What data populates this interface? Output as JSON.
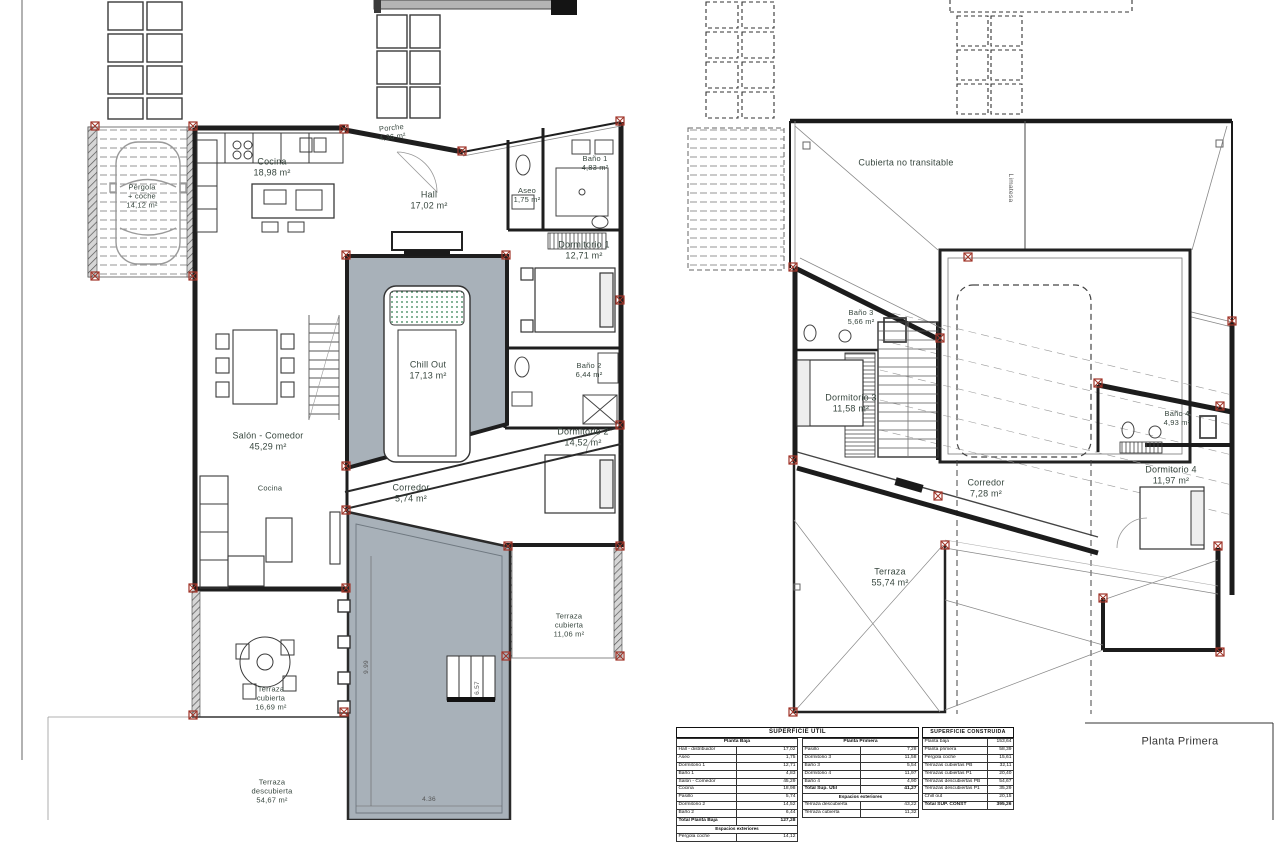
{
  "colors": {
    "label_text": "#37463e",
    "wall": "#1e1e1e",
    "pool_gray": "#a8b1b9",
    "marker_red": "#a03428"
  },
  "plan_left": {
    "labels": {
      "pergola": "Pérgola\n+ coche\n14,12 m²",
      "porche": "Porche\n4,36 m²",
      "cocina": "Cocina\n18,98 m²",
      "hall": "Hall\n17,02 m²",
      "aseo": "Aseo\n1,75 m²",
      "bano1": "Baño 1\n4,83 m²",
      "dormitorio1": "Dormitorio 1\n12,71 m²",
      "chill_out": "Chill Out\n17,13 m²",
      "bano2": "Baño 2\n6,44 m²",
      "salon": "Salón - Comedor\n45,29 m²",
      "cocina2": "Cocina",
      "corredor": "Corredor\n5,74 m²",
      "dormitorio2": "Dormitorio 2\n14,52 m²",
      "terraza_cubierta_der": "Terraza\ncubierta\n11,06 m²",
      "terraza_cubierta_izq": "Terraza\ncubierta\n16,69 m²",
      "terraza_descubierta": "Terraza\ndescubierta\n54,67 m²",
      "dim_pool_alto": "9.99",
      "dim_pool_ancho": "4.36",
      "dim_pool_lado": "6.57"
    }
  },
  "plan_right": {
    "labels": {
      "cubierta": "Cubierta no transitable",
      "limatesa": "Limatesa",
      "bano3": "Baño 3\n5,66 m²",
      "dormitorio3": "Dormitorio 3\n11,58 m²",
      "bano4": "Baño 4\n4,93 m²",
      "corredor": "Corredor\n7,28 m²",
      "dormitorio4": "Dormitorio 4\n11,97 m²",
      "terraza": "Terraza\n55,74 m²",
      "sheet_name": "Planta Primera"
    }
  },
  "tables": {
    "util": {
      "title": "SUPERFICIE ÚTIL",
      "baja": {
        "header": "Planta Baja",
        "rows": [
          [
            "Hall - distribuidor",
            "17,02"
          ],
          [
            "Aseo",
            "1,75"
          ],
          [
            "Dormitorio 1",
            "12,71"
          ],
          [
            "Baño 1",
            "4,83"
          ],
          [
            "Salón - Comedor",
            "45,29"
          ],
          [
            "Cocina",
            "18,98"
          ],
          [
            "Pasillo",
            "5,74"
          ],
          [
            "Dormitorio 2",
            "14,52"
          ],
          [
            "Baño 2",
            "6,44"
          ]
        ],
        "total": [
          "Total Planta Baja",
          "127,28"
        ],
        "section": "Espacios exteriores",
        "extra": [
          [
            "Pérgola coche",
            "14,12"
          ]
        ]
      },
      "primera": {
        "header": "Planta Primera",
        "rows": [
          [
            "Pasillo",
            "7,28"
          ],
          [
            "Dormitorio 3",
            "11,58"
          ],
          [
            "Baño 3",
            "5,54"
          ],
          [
            "Dormitorio 4",
            "11,97"
          ],
          [
            "Baño 4",
            "4,90"
          ]
        ],
        "total": [
          "Total Sup. Útil",
          "41,27"
        ],
        "section": "Espacios exteriores",
        "extra": [
          [
            "Terraza descubierta",
            "43,22"
          ],
          [
            "Terraza cubierta",
            "11,32"
          ]
        ]
      }
    },
    "construida": {
      "title": "SUPERFICIE CONSTRUIDA",
      "rows": [
        [
          "Planta baja",
          "153,64"
        ],
        [
          "Planta primera",
          "58,39"
        ],
        [
          "Pérgola coche",
          "15,61"
        ],
        [
          "Terrazas cubiertas PB",
          "32,11"
        ],
        [
          "Terrazas cubiertas P1",
          "20,40"
        ],
        [
          "Terrazas descubiertas PB",
          "54,67"
        ],
        [
          "Terrazas descubiertas P1",
          "35,29"
        ],
        [
          "Chill out",
          "20,15"
        ]
      ],
      "total": [
        "Total SUP. CONST",
        "395,26"
      ]
    }
  }
}
